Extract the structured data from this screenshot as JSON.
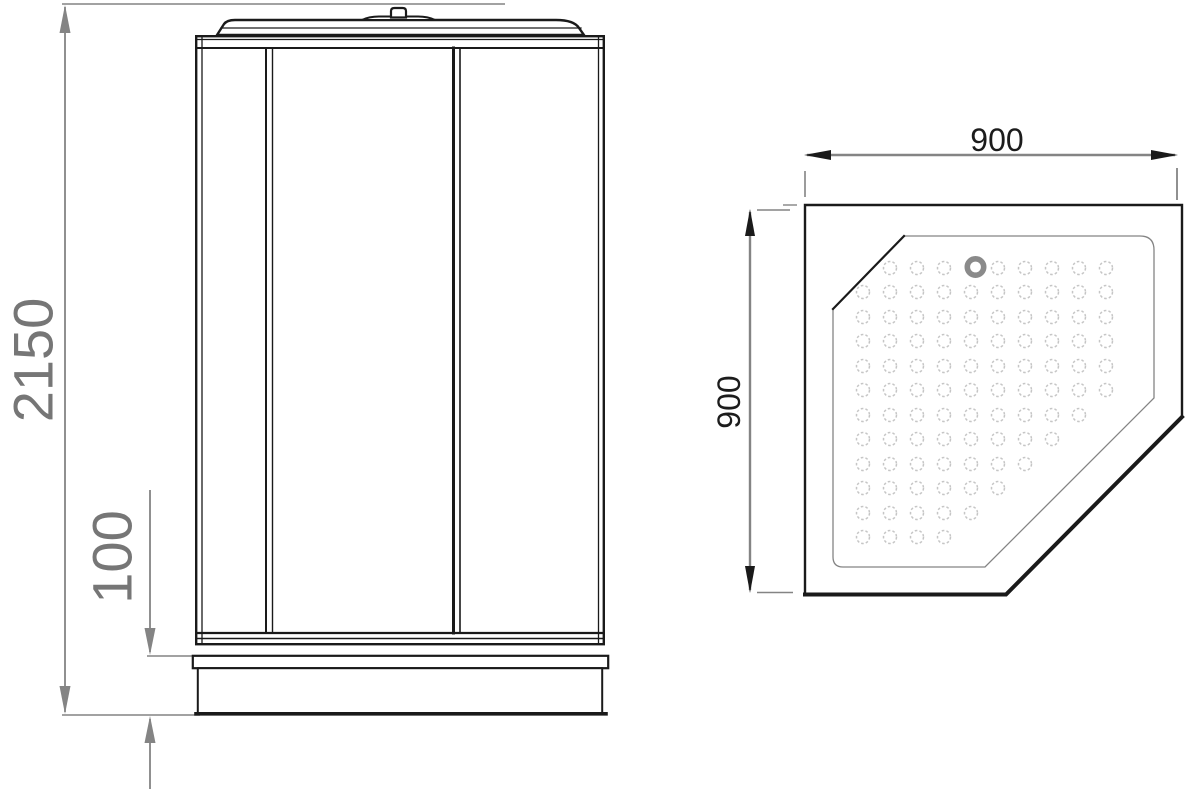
{
  "dims": {
    "height": "2150",
    "tray_height": "100",
    "tray_width": "900",
    "tray_depth": "900"
  },
  "colors": {
    "line_black": "#1a1a1a",
    "dim_gray": "#848484",
    "label_gray": "#767676",
    "label_black": "#1c1c1c",
    "hole_gray": "#c6c6c6",
    "drain_gray": "#8a8a8a",
    "background": "#ffffff"
  },
  "plan_holes": {
    "col_x": [
      863,
      890,
      917,
      944,
      971,
      998,
      1025,
      1052,
      1079,
      1106
    ],
    "hole_radius": 6.5,
    "rows": [
      {
        "y": 268,
        "cols": [
          2,
          3,
          4,
          6,
          7,
          8,
          9,
          10
        ]
      },
      {
        "y": 292,
        "cols": [
          1,
          2,
          3,
          4,
          5,
          6,
          7,
          8,
          9,
          10
        ]
      },
      {
        "y": 317,
        "cols": [
          1,
          2,
          3,
          4,
          5,
          6,
          7,
          8,
          9,
          10
        ]
      },
      {
        "y": 341,
        "cols": [
          1,
          2,
          3,
          4,
          5,
          6,
          7,
          8,
          9,
          10
        ]
      },
      {
        "y": 366,
        "cols": [
          1,
          2,
          3,
          4,
          5,
          6,
          7,
          8,
          9,
          10
        ]
      },
      {
        "y": 390,
        "cols": [
          1,
          2,
          3,
          4,
          5,
          6,
          7,
          8,
          9,
          10
        ]
      },
      {
        "y": 415,
        "cols": [
          1,
          2,
          3,
          4,
          5,
          6,
          7,
          8,
          9
        ]
      },
      {
        "y": 439,
        "cols": [
          1,
          2,
          3,
          4,
          5,
          6,
          7,
          8
        ]
      },
      {
        "y": 464,
        "cols": [
          1,
          2,
          3,
          4,
          5,
          6,
          7
        ]
      },
      {
        "y": 488,
        "cols": [
          1,
          2,
          3,
          4,
          5,
          6
        ]
      },
      {
        "y": 513,
        "cols": [
          1,
          2,
          3,
          4,
          5
        ]
      },
      {
        "y": 537,
        "cols": [
          1,
          2,
          3,
          4
        ]
      }
    ],
    "drain": {
      "cx": 975.5,
      "cy": 267,
      "r": 8.2,
      "stroke_width": 5.6
    }
  }
}
